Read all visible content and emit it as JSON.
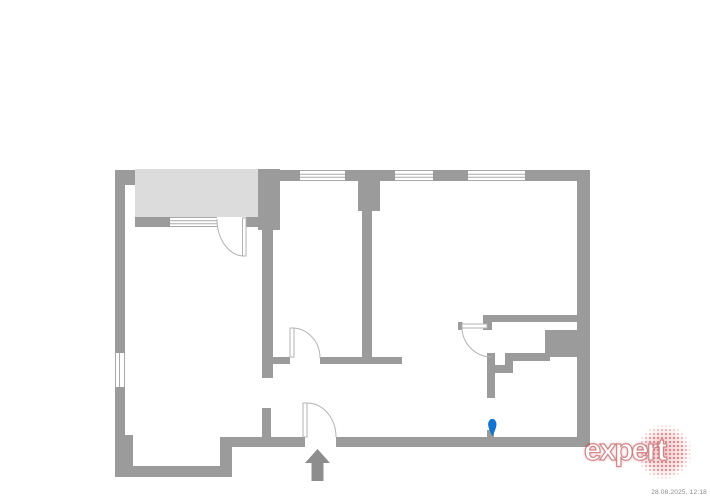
{
  "colors": {
    "wall": "#9b9b9b",
    "wall-line": "#a9a9a9",
    "door-line": "#b3b3b3",
    "balcony": "#dcdcdc",
    "arrow": "#8d8d8d",
    "pin": "#1274cf",
    "logo-red": "#c62b33",
    "timestamp": "#8a8a8a"
  },
  "floorplan": {
    "type": "apartment-floor-plan",
    "icons": {
      "entrance_arrow": "up-arrow",
      "position_marker": "blue-pin",
      "doors": "quarter-circle-swing",
      "windows": "double-line-glazing"
    }
  },
  "logo": {
    "text": "expert"
  },
  "footer": {
    "timestamp": "28.08.2025, 12:18"
  }
}
